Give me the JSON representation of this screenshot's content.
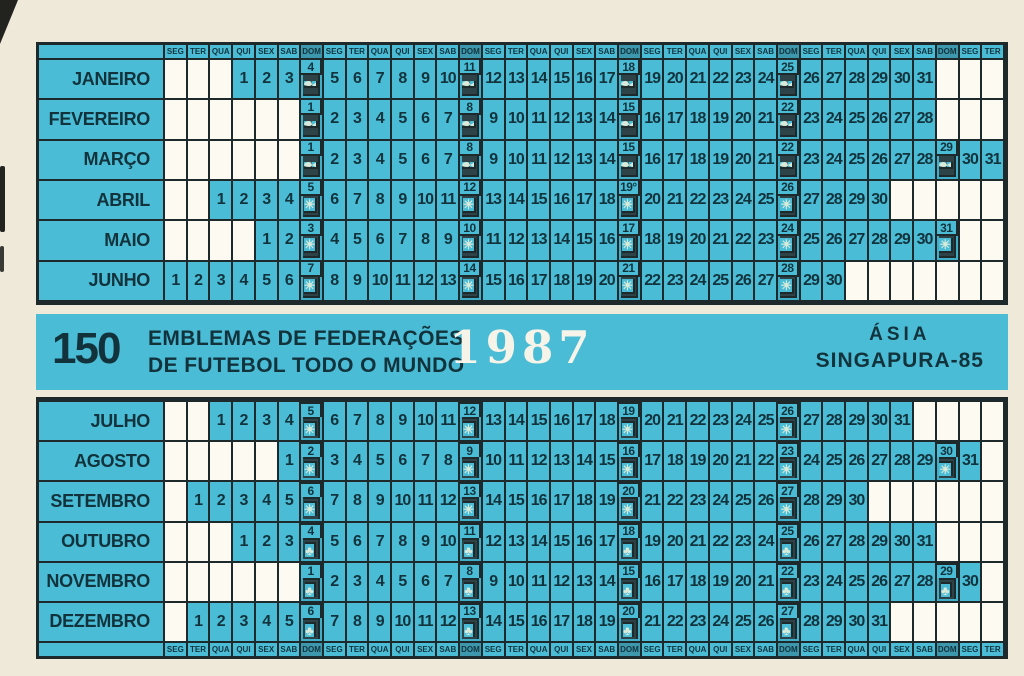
{
  "band": {
    "series_number": "150",
    "title_line1": "EMBLEMAS DE FEDERAÇÕES",
    "title_line2": "DE FUTEBOL TODO O MUNDO",
    "year": "1987",
    "region": "ÁSIA",
    "edition": "SINGAPURA-85"
  },
  "weekday_names": [
    "SEG",
    "TER",
    "QUA",
    "QUI",
    "SEX",
    "SAB",
    "DOM"
  ],
  "grid_columns": 37,
  "months": [
    {
      "name": "JANEIRO",
      "start_col": 4,
      "days": 31,
      "sunday_symbol": "fish",
      "sundays": [
        4,
        11,
        18,
        25
      ]
    },
    {
      "name": "FEVEREIRO",
      "start_col": 7,
      "days": 28,
      "sunday_symbol": "fish",
      "sundays": [
        1,
        8,
        15,
        22
      ]
    },
    {
      "name": "MARÇO",
      "start_col": 7,
      "days": 31,
      "sunday_symbol": "fish",
      "sundays": [
        1,
        8,
        15,
        22,
        29
      ]
    },
    {
      "name": "ABRIL",
      "start_col": 3,
      "days": 30,
      "sunday_symbol": "star",
      "sundays": [
        5,
        12,
        19,
        26
      ],
      "special_days": {
        "19": "19°"
      }
    },
    {
      "name": "MAIO",
      "start_col": 5,
      "days": 31,
      "sunday_symbol": "star",
      "sundays": [
        3,
        10,
        17,
        24,
        31
      ]
    },
    {
      "name": "JUNHO",
      "start_col": 1,
      "days": 30,
      "sunday_symbol": "star",
      "sundays": [
        7,
        14,
        21,
        28
      ]
    },
    {
      "name": "JULHO",
      "start_col": 3,
      "days": 31,
      "sunday_symbol": "star",
      "sundays": [
        5,
        12,
        19,
        26
      ]
    },
    {
      "name": "AGOSTO",
      "start_col": 6,
      "days": 31,
      "sunday_symbol": "star",
      "sundays": [
        2,
        9,
        16,
        23,
        30
      ]
    },
    {
      "name": "SETEMBRO",
      "start_col": 2,
      "days": 30,
      "sunday_symbol": "star",
      "sundays": [
        6,
        13,
        20,
        27
      ]
    },
    {
      "name": "OUTUBRO",
      "start_col": 4,
      "days": 31,
      "sunday_symbol": "clover",
      "sundays": [
        4,
        11,
        18,
        25
      ]
    },
    {
      "name": "NOVEMBRO",
      "start_col": 7,
      "days": 30,
      "sunday_symbol": "clover",
      "sundays": [
        1,
        8,
        15,
        22,
        29
      ]
    },
    {
      "name": "DEZEMBRO",
      "start_col": 2,
      "days": 31,
      "sunday_symbol": "clover",
      "sundays": [
        6,
        13,
        20,
        27
      ]
    }
  ],
  "colors": {
    "cell_blue": "#4abcd6",
    "sunday_cell_blue": "#3fafc9",
    "symbol_tile": "#2d4347",
    "grid_line": "#1e292b",
    "ink": "#12333c",
    "year_text": "#f6f3e8",
    "empty_cell": "#fcfaf1",
    "dom_header_cell": "#3e98ad",
    "card_background": "#efe9da"
  }
}
